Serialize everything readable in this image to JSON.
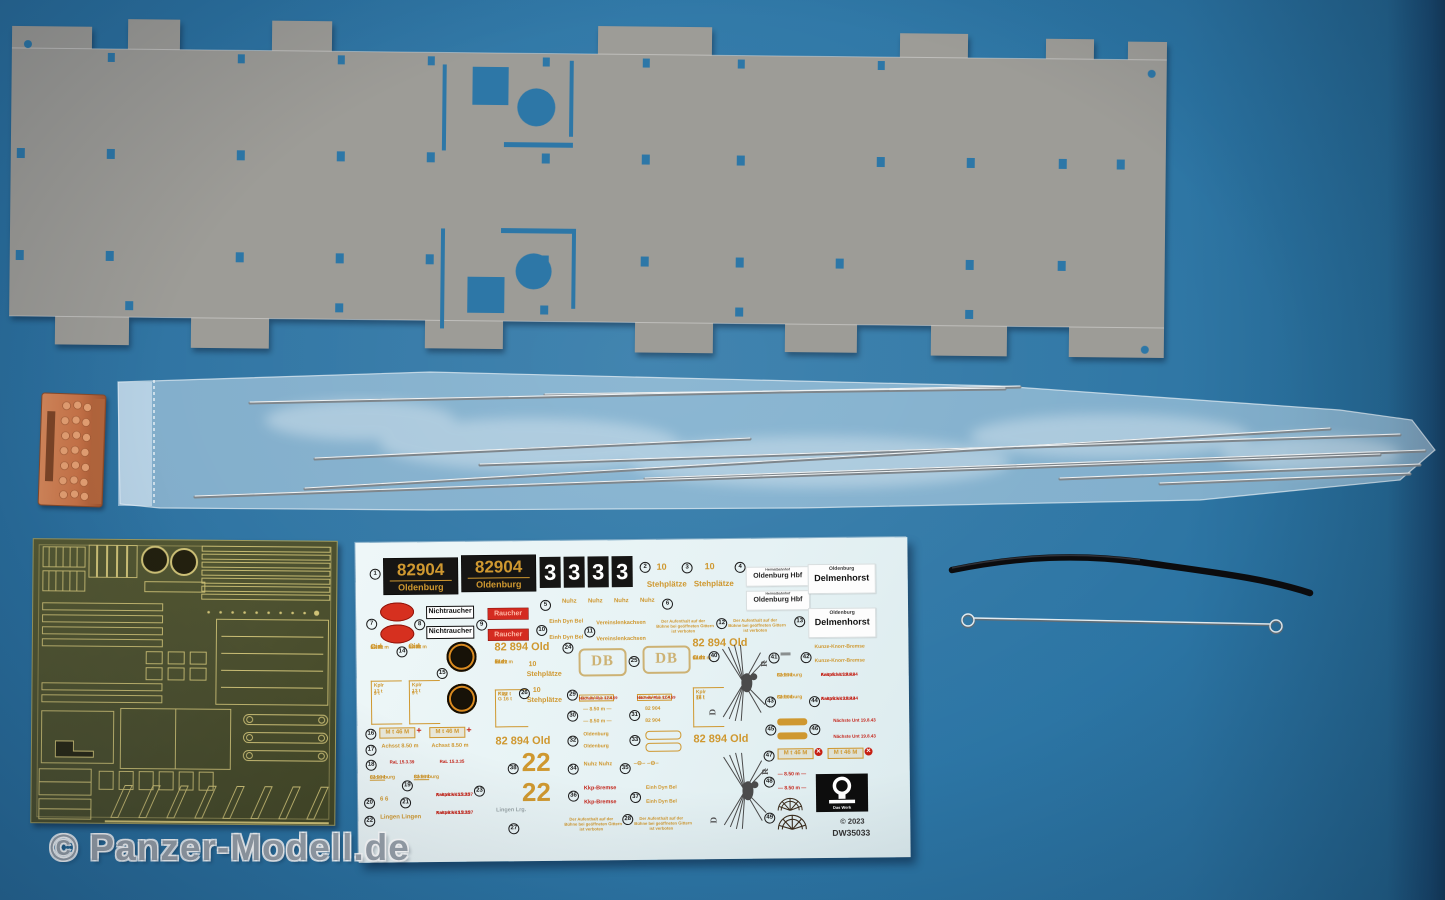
{
  "colors": {
    "background": "#2b74a3",
    "background_edge": "#1a4b72",
    "cardboard": "#9d9c97",
    "cardboard_hole": "#2d77a7",
    "paper": "#eaf5f6",
    "decal_gold": "#cf9830",
    "decal_red": "#c42318",
    "plate_black": "#161514",
    "brass_body": "#4d5130",
    "brass_line": "#cfc277",
    "copper": "#c97c4f",
    "steel": "#b9c2c8"
  },
  "watermark": {
    "text": "© Panzer-Modell.de"
  },
  "parts": {
    "cardboard_sheet": "laser-cut-cardboard-deck-sheet",
    "rod_bag": "clear-bag-with-steel-rods",
    "copper_block": "copper-resin-coupler-part",
    "etch_fret": "brass-photo-etch-fret",
    "black_tube": "black-flexible-tube",
    "eye_wire": "steel-wire-with-eye-ends"
  },
  "decal": {
    "plate_number": "82904",
    "plate_name": "Oldenburg",
    "digit": "3",
    "ten": "10",
    "stehplaetze": "Stehplätze",
    "nuhz": "Nuhz",
    "heimatbahnhof": "Heimatbahnhof",
    "oldenburg_hbf": "Oldenburg Hbf",
    "oldenburg": "Oldenburg",
    "delmenhorst": "Delmenhorst",
    "nichtraucher": "Nichtraucher",
    "raucher": "Raucher",
    "einh_dyn_bel": "Einh Dyn Bel",
    "vereinslenkachsen": "Vereinslenkachsen",
    "aufenthalt_l1": "Der Aufenthalt auf der",
    "aufenthalt_l2": "Bühne bei geöffneten Gittern",
    "aufenthalt_l3": "ist verboten",
    "cid": "Cid",
    "bid": "Bid",
    "spec_l1": "17.a t",
    "spec_l2": "66 Pl",
    "spec_l3": "13.92 m",
    "kplr": "Kplr",
    "kkp": "Kkp",
    "load_13": "13 t",
    "load_9": "9 t",
    "load_22": "22 t",
    "load_16": "16 t",
    "load_f22": "F 22 t",
    "load_g16": "G 16 t",
    "wagon_number": "82 894 Old",
    "db": "DB",
    "riv": "RIV RA  12.4.58",
    "next_rev": "Nächste Rev 12.4.59",
    "length_850": "— 8.50 m —",
    "running_number": "82 904",
    "big_two": "22",
    "nuhz_pair": "Nuhz   Nuhz",
    "axle_symbol": "–⊖–   –⊖–",
    "kkp_bremse": "Kkp-Bremse",
    "lingen": "Lingen   Lingen",
    "lingen_grey": "Lingen   Lrg.",
    "mt46": "M t 46 M",
    "plus": "+",
    "cross": "✕",
    "achsstand": "Achsst 8.50 m",
    "ral_39": "RaL 15.3.39",
    "ral_35": "RaL 15.3.35",
    "six_pair": "6   6",
    "kaltp_35": "Kaltpß  k 15.3.35",
    "anstrich_37": "Anstrichk 15.3.37",
    "kunze": "Kunze-Knorr-Bremse",
    "kaltp_43": "Kaltpß  k 19.8.43",
    "anstrich_44": "Anstrichk 19.8.44",
    "next_unt": "Nächste Unt 19.8.43",
    "eagle_d": "D",
    "eagle_r": "R",
    "das_werk": "Das Werk",
    "copyright": "© 2023",
    "product_code": "DW35033",
    "markers": {
      "m1": "1",
      "m2": "2",
      "m3": "3",
      "m4": "4",
      "m5": "5",
      "m6": "6",
      "m7": "7",
      "m8": "8",
      "m9": "9",
      "m10": "10",
      "m11": "11",
      "m12": "12",
      "m13": "13",
      "m14": "14",
      "m15": "15",
      "m16": "16",
      "m17": "17",
      "m18": "18",
      "m19": "19",
      "m20": "20",
      "m21": "21",
      "m22": "22",
      "m23": "23",
      "m24": "24",
      "m25": "25",
      "m26": "26",
      "m27": "27",
      "m28": "28",
      "m29": "29",
      "m30": "30",
      "m31": "31",
      "m32": "32",
      "m33": "33",
      "m34": "34",
      "m35": "35",
      "m36": "36",
      "m37": "37",
      "m38": "38",
      "m40": "40",
      "m41": "41",
      "m42": "42",
      "m43": "43",
      "m44": "44",
      "m45": "45",
      "m46": "46",
      "m47": "47",
      "m48": "48",
      "m49": "49"
    }
  }
}
